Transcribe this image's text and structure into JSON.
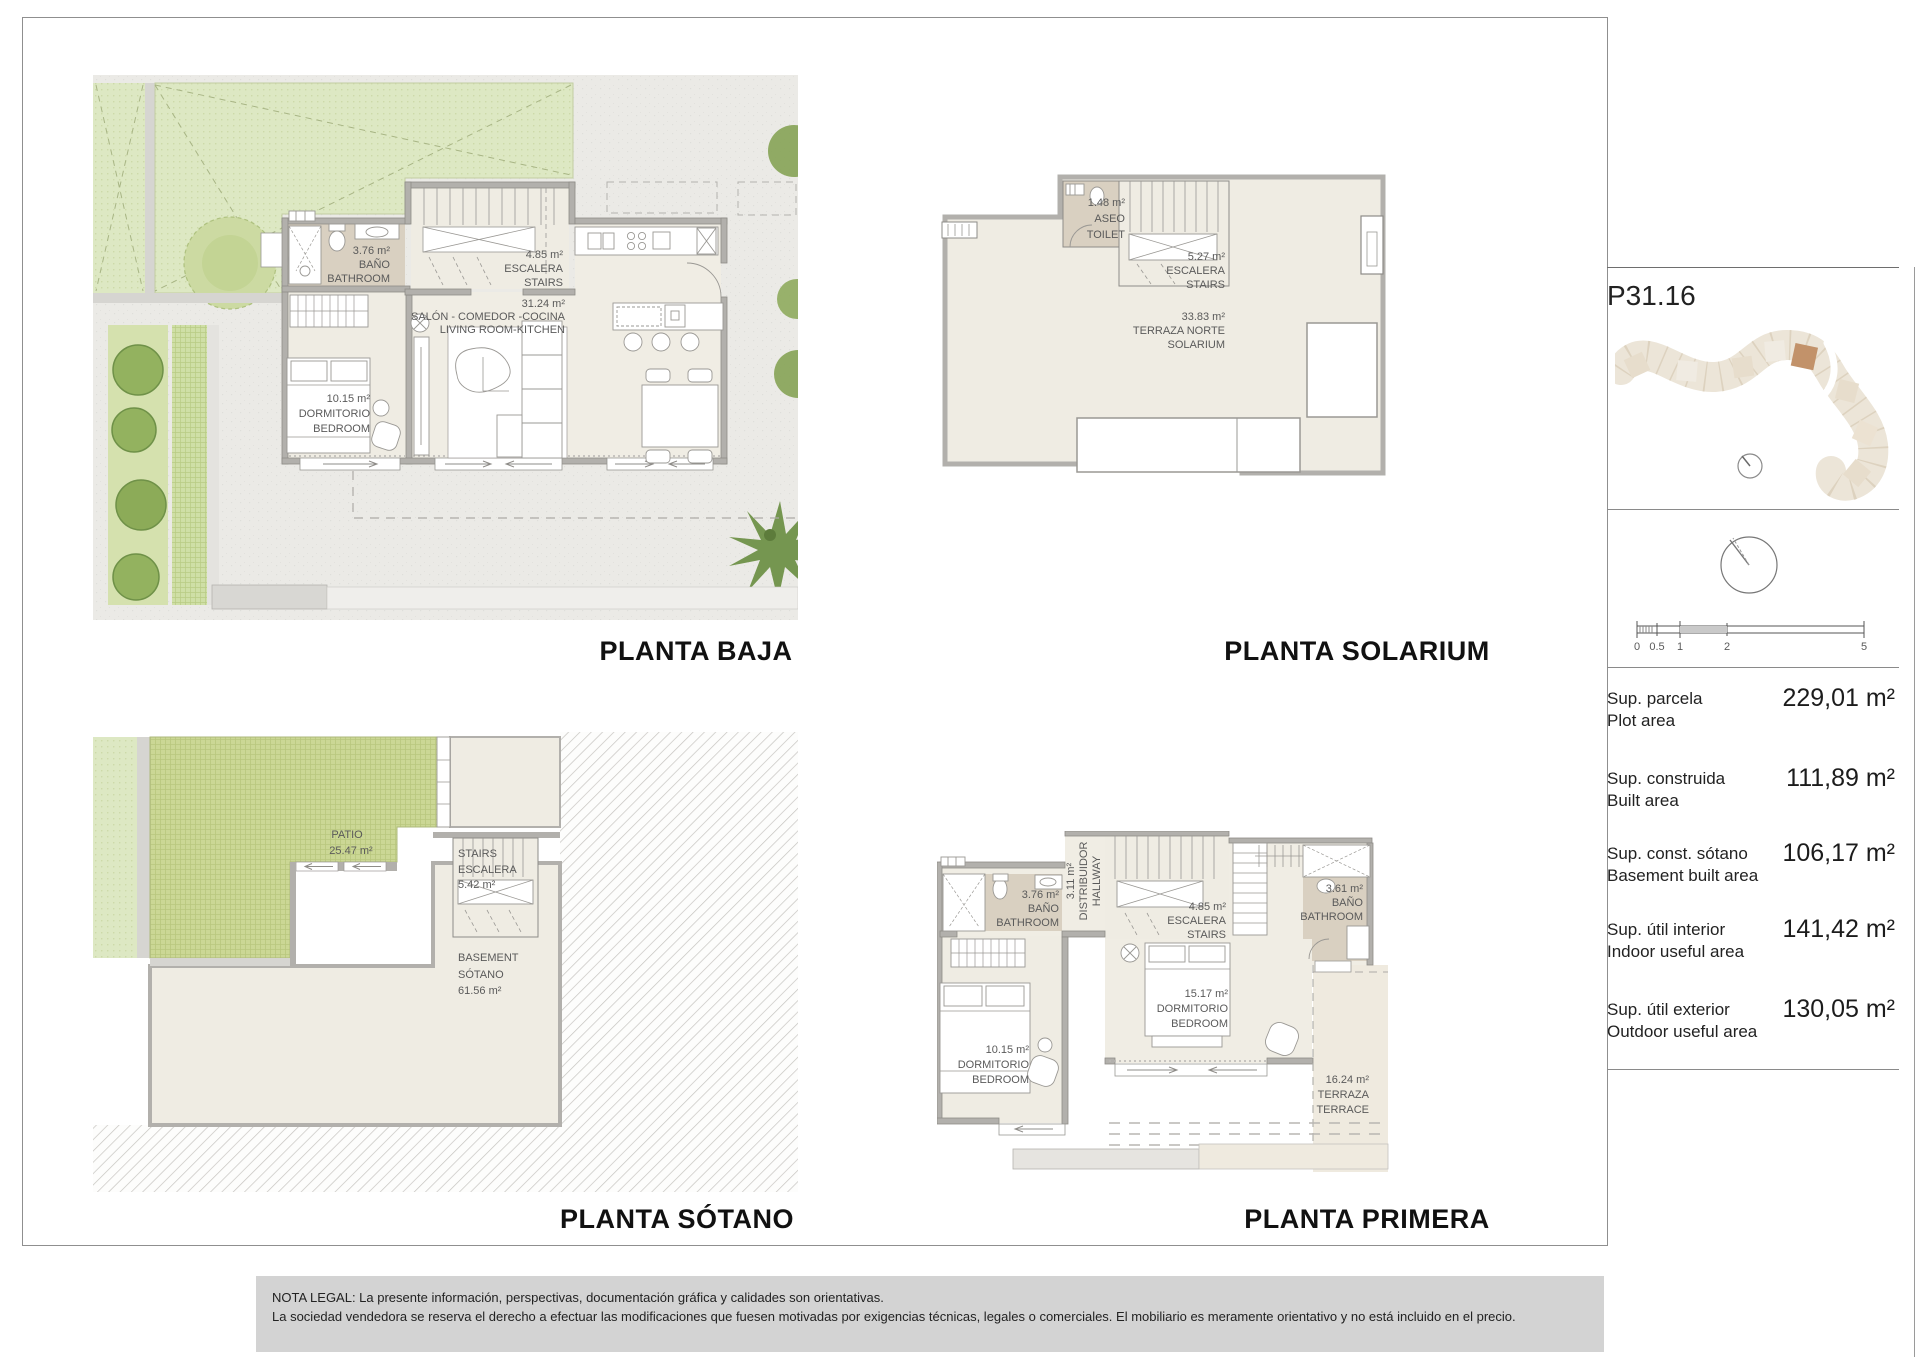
{
  "unit_code": "P31.16",
  "titles": {
    "baja": "PLANTA BAJA",
    "solarium": "PLANTA SOLARIUM",
    "sotano": "PLANTA SÓTANO",
    "primera": "PLANTA PRIMERA"
  },
  "baja": {
    "bathroom": [
      "3.76 m²",
      "BAÑO",
      "BATHROOM"
    ],
    "stairs": [
      "4.85 m²",
      "ESCALERA",
      "STAIRS"
    ],
    "living": [
      "31.24 m²",
      "SALÓN - COMEDOR -COCINA",
      "LIVING ROOM-KITCHEN"
    ],
    "bedroom": [
      "10.15 m²",
      "DORMITORIO",
      "BEDROOM"
    ]
  },
  "solarium": {
    "toilet": [
      "1.48 m²",
      "ASEO",
      "TOILET"
    ],
    "stairs": [
      "5.27 m²",
      "ESCALERA",
      "STAIRS"
    ],
    "terrace": [
      "33.83 m²",
      "TERRAZA NORTE",
      "SOLARIUM"
    ]
  },
  "sotano": {
    "patio": [
      "PATIO",
      "25.47 m²"
    ],
    "stairs": [
      "STAIRS",
      "ESCALERA",
      "5.42 m²"
    ],
    "basement": [
      "BASEMENT",
      "SÓTANO",
      "61.56 m²"
    ]
  },
  "primera": {
    "bath1": [
      "3.76 m²",
      "BAÑO",
      "BATHROOM"
    ],
    "hallway": [
      "3.11 m²",
      "DISTRIBUIDOR",
      "HALLWAY"
    ],
    "stairs": [
      "4.85 m²",
      "ESCALERA",
      "STAIRS"
    ],
    "bath2": [
      "3.61 m²",
      "BAÑO",
      "BATHROOM"
    ],
    "bed_main": [
      "15.17 m²",
      "DORMITORIO",
      "BEDROOM"
    ],
    "bed_second": [
      "10.15 m²",
      "DORMITORIO",
      "BEDROOM"
    ],
    "terrace": [
      "16.24 m²",
      "TERRAZA",
      "TERRACE"
    ]
  },
  "scalebar": {
    "ticks": [
      "0",
      "0.5",
      "1",
      "2",
      "5"
    ]
  },
  "areas": [
    {
      "es": "Sup. parcela",
      "en": "Plot area",
      "value": "229,01 m²"
    },
    {
      "es": "Sup. construida",
      "en": "Built area",
      "value": "111,89 m²"
    },
    {
      "es": "Sup. const. sótano",
      "en": "Basement built area",
      "value": "106,17 m²"
    },
    {
      "es": "Sup. útil interior",
      "en": "Indoor useful area",
      "value": "141,42 m²"
    },
    {
      "es": "Sup. útil exterior",
      "en": "Outdoor useful area",
      "value": "130,05 m²"
    }
  ],
  "legal": {
    "line1": "NOTA LEGAL: La presente información, perspectivas, documentación gráfica y calidades son orientativas.",
    "line2": "La sociedad vendedora se reserva el derecho a efectuar las modificaciones que fuesen motivadas por exigencias técnicas, legales o comerciales. El mobiliario es meramente orientativo y no está incluido en el precio."
  },
  "colors": {
    "highlight_unit": "#c2926a",
    "garden_green": "#dde8c3",
    "patio_green": "#cbd795",
    "floor_beige": "#f0ede4",
    "bath_floor": "#d9d0c1",
    "wall_gray": "#b2b0ac",
    "legal_band": "#d3d3d3"
  }
}
